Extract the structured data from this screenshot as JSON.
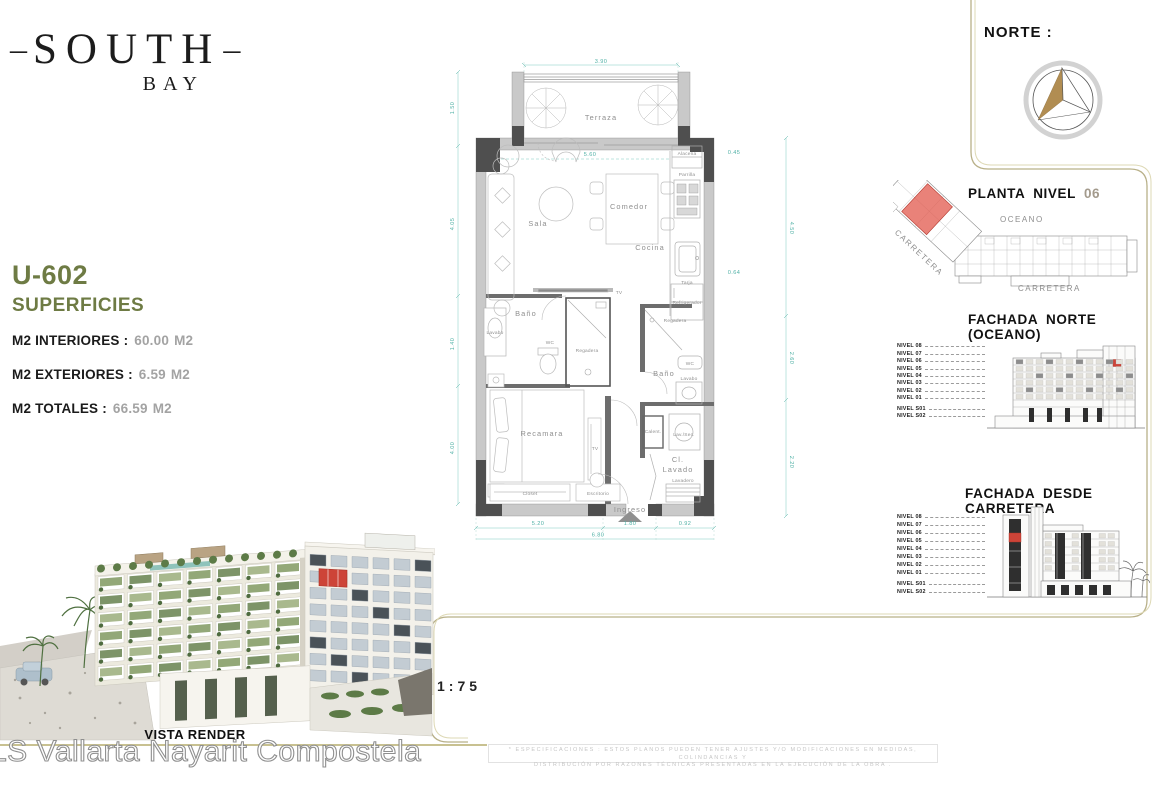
{
  "logo": {
    "dash": "–",
    "title": "SOUTH",
    "subtitle": "BAY"
  },
  "unit": {
    "id": "U-602",
    "section_title": "SUPERFICIES",
    "rows": [
      {
        "label": "M2 INTERIORES :",
        "value": "60.00",
        "unit": "M2"
      },
      {
        "label": "M2 EXTERIORES :",
        "value": "6.59",
        "unit": "M2"
      },
      {
        "label": "M2 TOTALES :",
        "value": "66.59",
        "unit": "M2"
      }
    ]
  },
  "plan": {
    "rooms": {
      "terraza": "Terraza",
      "sala": "Sala",
      "comedor": "Comedor",
      "cocina": "Cocina",
      "bano1": "Baño",
      "bano2": "Baño",
      "recamara": "Recamara",
      "cl_line1": "Cl.",
      "cl_line2": "Lavado",
      "ingreso": "Ingreso"
    },
    "fixtures": {
      "alacena": "Alacena",
      "parrilla": "Parrilla",
      "tarja": "Tarja",
      "refrigerador": "Refrigerador",
      "lavabo1": "Lavabo",
      "wc1": "WC",
      "regadera1": "Regadera",
      "tv1": "TV",
      "tv2": "TV",
      "closet": "Closet",
      "escritorio": "Escritorio",
      "regadera2": "Regadera",
      "wc2": "WC",
      "lavabo2": "Lavabo",
      "calent": "Calent.",
      "lav_sec": "Lav./Sec.",
      "lavadero": "Lavadero"
    },
    "dims": {
      "top": "3.90",
      "inner": "5.60",
      "total_bottom": "6.80",
      "left": [
        "1.50",
        "4.05",
        "1.40",
        "4.00"
      ],
      "right": [
        "0.45",
        "4.50",
        "2.60",
        "2.20"
      ],
      "bottom": [
        "5.20",
        "1.80",
        "0.92"
      ],
      "kitchen": [
        "0.48",
        "0.64"
      ]
    }
  },
  "north": {
    "label": "NORTE :"
  },
  "key_plan": {
    "title": "PLANTA NIVEL",
    "level": "06",
    "ocean_label": "OCEANO",
    "road_label": "CARRETERA",
    "road_label_angled": "CARRETERA"
  },
  "elevation_north": {
    "title": "FACHADA NORTE (OCEANO)"
  },
  "elevation_road": {
    "title": "FACHADA DESDE CARRETERA"
  },
  "levels": [
    "NIVEL 08",
    "NIVEL 07",
    "NIVEL 06",
    "NIVEL 05",
    "NIVEL 04",
    "NIVEL 03",
    "NIVEL 02",
    "NIVEL 01",
    "NIVEL S01",
    "NIVEL S02"
  ],
  "render": {
    "caption": "VISTA RENDER"
  },
  "scale": {
    "value": "1:75"
  },
  "watermark": {
    "text": "LS Vallarta Nayarit Compostela"
  },
  "disclaimer": {
    "line1": "* ESPECIFICACIONES : ESTOS PLANOS PUEDEN TENER AJUSTES Y/O MODIFICACIONES EN MEDIDAS, COLINDANCIAS Y",
    "line2": "DISTRIBUCIÓN POR RAZONES TÉCNICAS PRESENTADAS EN LA EJECUCIÓN DE LA OBRA ."
  },
  "colors": {
    "accent_olive": "#6e7b44",
    "highlight_red": "#cd4438",
    "frame_gold": "#b8b088",
    "dim_teal": "#4fb0a5"
  }
}
